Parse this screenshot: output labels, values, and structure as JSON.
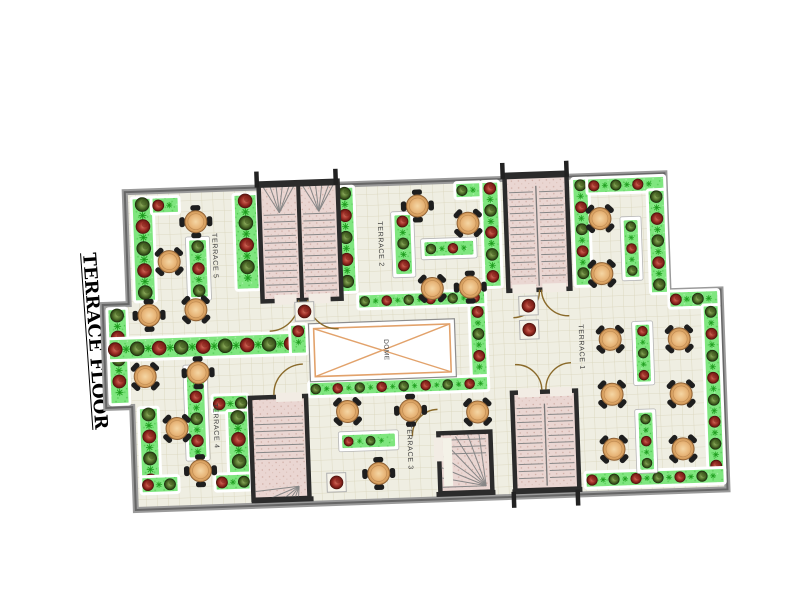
{
  "title": {
    "text": "TERRACE FLOOR"
  },
  "colors": {
    "floor": "#efeee2",
    "grid": "#d9d4ba",
    "planter": "#7fe67f",
    "sprig": "#28a828",
    "bush_red_dark": "#5c130d",
    "bush_green_dark": "#22350f",
    "stair_fill": "#ead6d2",
    "wall": "#8f8f8f",
    "wall_dark": "#2b2b2b",
    "table": "#e7b477",
    "dome_accent": "#e2a26b",
    "door": "#8a6a2a",
    "label": "#3c3c3c"
  },
  "plan": {
    "rotation_deg": -2,
    "origin": {
      "viewbox": "-100 -25 720 360"
    },
    "outline": "M0 0 H540 V118 H592 V318 H0 V215 H-26 V112 H0 Z",
    "terraces": [
      {
        "id": "terrace-5",
        "label": "TERRACE 5",
        "x": 86,
        "y": 44
      },
      {
        "id": "terrace-2",
        "label": "TERRACE 2",
        "x": 252,
        "y": 38
      },
      {
        "id": "terrace-1",
        "label": "TERRACE 1",
        "x": 449,
        "y": 148
      },
      {
        "id": "terrace-4",
        "label": "TERRACE 4",
        "x": 81,
        "y": 214
      },
      {
        "id": "terrace-3",
        "label": "TERRACE 3",
        "x": 274,
        "y": 242
      }
    ],
    "dome": {
      "label": "DOME",
      "x": 179,
      "y": 138,
      "w": 146,
      "h": 58
    },
    "planters": [
      {
        "x": 6,
        "y": 6,
        "w": 22,
        "h": 104
      },
      {
        "x": 26,
        "y": 6,
        "w": 28,
        "h": 17
      },
      {
        "x": 62,
        "y": 50,
        "w": 18,
        "h": 58,
        "i": 1
      },
      {
        "x": 108,
        "y": 6,
        "w": 24,
        "h": 96
      },
      {
        "x": -22,
        "y": 116,
        "w": 20,
        "h": 96
      },
      {
        "x": -22,
        "y": 146,
        "w": 198,
        "h": 22
      },
      {
        "x": 6,
        "y": 216,
        "w": 20,
        "h": 86
      },
      {
        "x": 6,
        "y": 285,
        "w": 38,
        "h": 17
      },
      {
        "x": 55,
        "y": 178,
        "w": 18,
        "h": 90,
        "i": 1
      },
      {
        "x": 80,
        "y": 206,
        "w": 36,
        "h": 18
      },
      {
        "x": 94,
        "y": 222,
        "w": 22,
        "h": 64
      },
      {
        "x": 80,
        "y": 285,
        "w": 36,
        "h": 17
      },
      {
        "x": 210,
        "y": 2,
        "w": 19,
        "h": 106
      },
      {
        "x": 268,
        "y": 32,
        "w": 17,
        "h": 60,
        "i": 1
      },
      {
        "x": 297,
        "y": 60,
        "w": 50,
        "h": 15,
        "i": 1
      },
      {
        "x": 356,
        "y": 2,
        "w": 18,
        "h": 106
      },
      {
        "x": 330,
        "y": 2,
        "w": 26,
        "h": 16
      },
      {
        "x": 160,
        "y": 138,
        "w": 17,
        "h": 30
      },
      {
        "x": 229,
        "y": 110,
        "w": 128,
        "h": 15
      },
      {
        "x": 340,
        "y": 125,
        "w": 17,
        "h": 71
      },
      {
        "x": 177,
        "y": 196,
        "w": 180,
        "h": 15
      },
      {
        "x": 208,
        "y": 250,
        "w": 54,
        "h": 14,
        "i": 1
      },
      {
        "x": 447,
        "y": 2,
        "w": 17,
        "h": 108
      },
      {
        "x": 462,
        "y": 2,
        "w": 78,
        "h": 16
      },
      {
        "x": 522,
        "y": 16,
        "w": 18,
        "h": 104
      },
      {
        "x": 540,
        "y": 118,
        "w": 50,
        "h": 17
      },
      {
        "x": 573,
        "y": 133,
        "w": 17,
        "h": 168
      },
      {
        "x": 450,
        "y": 296,
        "w": 140,
        "h": 16
      },
      {
        "x": 497,
        "y": 45,
        "w": 15,
        "h": 58,
        "i": 1
      },
      {
        "x": 505,
        "y": 150,
        "w": 15,
        "h": 58,
        "i": 1
      },
      {
        "x": 505,
        "y": 238,
        "w": 15,
        "h": 58,
        "i": 1
      }
    ],
    "stairs": [
      {
        "id": "stair-top-left",
        "x": 134,
        "y": -4,
        "w": 79,
        "h": 118,
        "cells": 2,
        "fan": "top",
        "tm": 32,
        "bm": 8
      },
      {
        "id": "stair-top-right",
        "x": 380,
        "y": -4,
        "w": 62,
        "h": 116,
        "divider": true,
        "tm": 18,
        "bm": 10
      },
      {
        "id": "stair-bottom-left",
        "x": 118,
        "y": 210,
        "w": 56,
        "h": 102,
        "fan": "bottom",
        "tm": 20,
        "bm": 34
      },
      {
        "id": "stair-winder",
        "x": 305,
        "y": 252,
        "w": 52,
        "h": 60,
        "winder": true
      },
      {
        "id": "stair-bottom-right",
        "x": 380,
        "y": 214,
        "w": 64,
        "h": 98,
        "divider": true,
        "tm": 16,
        "bm": 12
      }
    ],
    "door_gaps": [
      {
        "x": 146,
        "y": 108,
        "w": 22,
        "h": 10
      },
      {
        "x": 180,
        "y": 108,
        "w": 22,
        "h": 10
      },
      {
        "x": 384,
        "y": 106,
        "w": 24,
        "h": 9
      },
      {
        "x": 414,
        "y": 106,
        "w": 24,
        "h": 9
      },
      {
        "x": 144,
        "y": 206,
        "w": 26,
        "h": 9
      },
      {
        "x": 300,
        "y": 256,
        "w": 9,
        "h": 24
      },
      {
        "x": 386,
        "y": 210,
        "w": 22,
        "h": 9
      },
      {
        "x": 418,
        "y": 210,
        "w": 22,
        "h": 9
      }
    ],
    "door_arcs": [
      {
        "px": 140,
        "py": 114,
        "r": 30,
        "from": "E",
        "to": "S",
        "sweep": 1
      },
      {
        "px": 209,
        "py": 114,
        "r": 30,
        "from": "W",
        "to": "S",
        "sweep": 0
      },
      {
        "px": 384,
        "py": 112,
        "r": 27,
        "from": "E",
        "to": "S",
        "sweep": 1
      },
      {
        "px": 440,
        "py": 112,
        "r": 27,
        "from": "W",
        "to": "S",
        "sweep": 0
      },
      {
        "px": 172,
        "py": 208,
        "r": 30,
        "from": "W",
        "to": "N",
        "sweep": 1
      },
      {
        "px": 305,
        "py": 254,
        "r": 26,
        "from": "W",
        "to": "N",
        "sweep": 1
      },
      {
        "px": 384,
        "py": 212,
        "r": 26,
        "from": "E",
        "to": "N",
        "sweep": 0
      },
      {
        "px": 440,
        "py": 212,
        "r": 26,
        "from": "W",
        "to": "N",
        "sweep": 1
      }
    ],
    "pots": [
      {
        "x": 166,
        "y": 116
      },
      {
        "x": 192,
        "y": 288
      },
      {
        "x": 390,
        "y": 118
      },
      {
        "x": 390,
        "y": 142
      }
    ],
    "tables": [
      [
        70,
        32,
        0
      ],
      [
        42,
        71,
        45
      ],
      [
        20,
        124,
        0
      ],
      [
        67,
        120,
        45
      ],
      [
        14,
        185,
        45
      ],
      [
        67,
        183,
        0
      ],
      [
        44,
        238,
        45
      ],
      [
        66,
        281,
        0
      ],
      [
        292,
        24,
        0
      ],
      [
        342,
        43,
        45
      ],
      [
        304,
        107,
        45
      ],
      [
        342,
        107,
        0
      ],
      [
        215,
        227,
        45
      ],
      [
        278,
        228,
        0
      ],
      [
        345,
        232,
        45
      ],
      [
        244,
        290,
        0
      ],
      [
        474,
        43,
        45
      ],
      [
        474,
        98,
        45
      ],
      [
        480,
        164,
        45
      ],
      [
        549,
        166,
        45
      ],
      [
        480,
        219,
        45
      ],
      [
        549,
        221,
        45
      ],
      [
        480,
        274,
        45
      ],
      [
        549,
        276,
        45
      ]
    ],
    "wall_segments": [
      [
        132,
        -2,
        215,
        -2
      ],
      [
        378,
        -2,
        444,
        -2
      ],
      [
        116,
        313,
        178,
        313
      ],
      [
        301,
        313,
        360,
        313
      ],
      [
        377,
        313,
        447,
        313
      ]
    ],
    "posts": [
      [
        130,
        -16
      ],
      [
        209,
        -16
      ],
      [
        376,
        -16
      ],
      [
        440,
        -16
      ],
      [
        376,
        313
      ],
      [
        440,
        313
      ]
    ]
  }
}
